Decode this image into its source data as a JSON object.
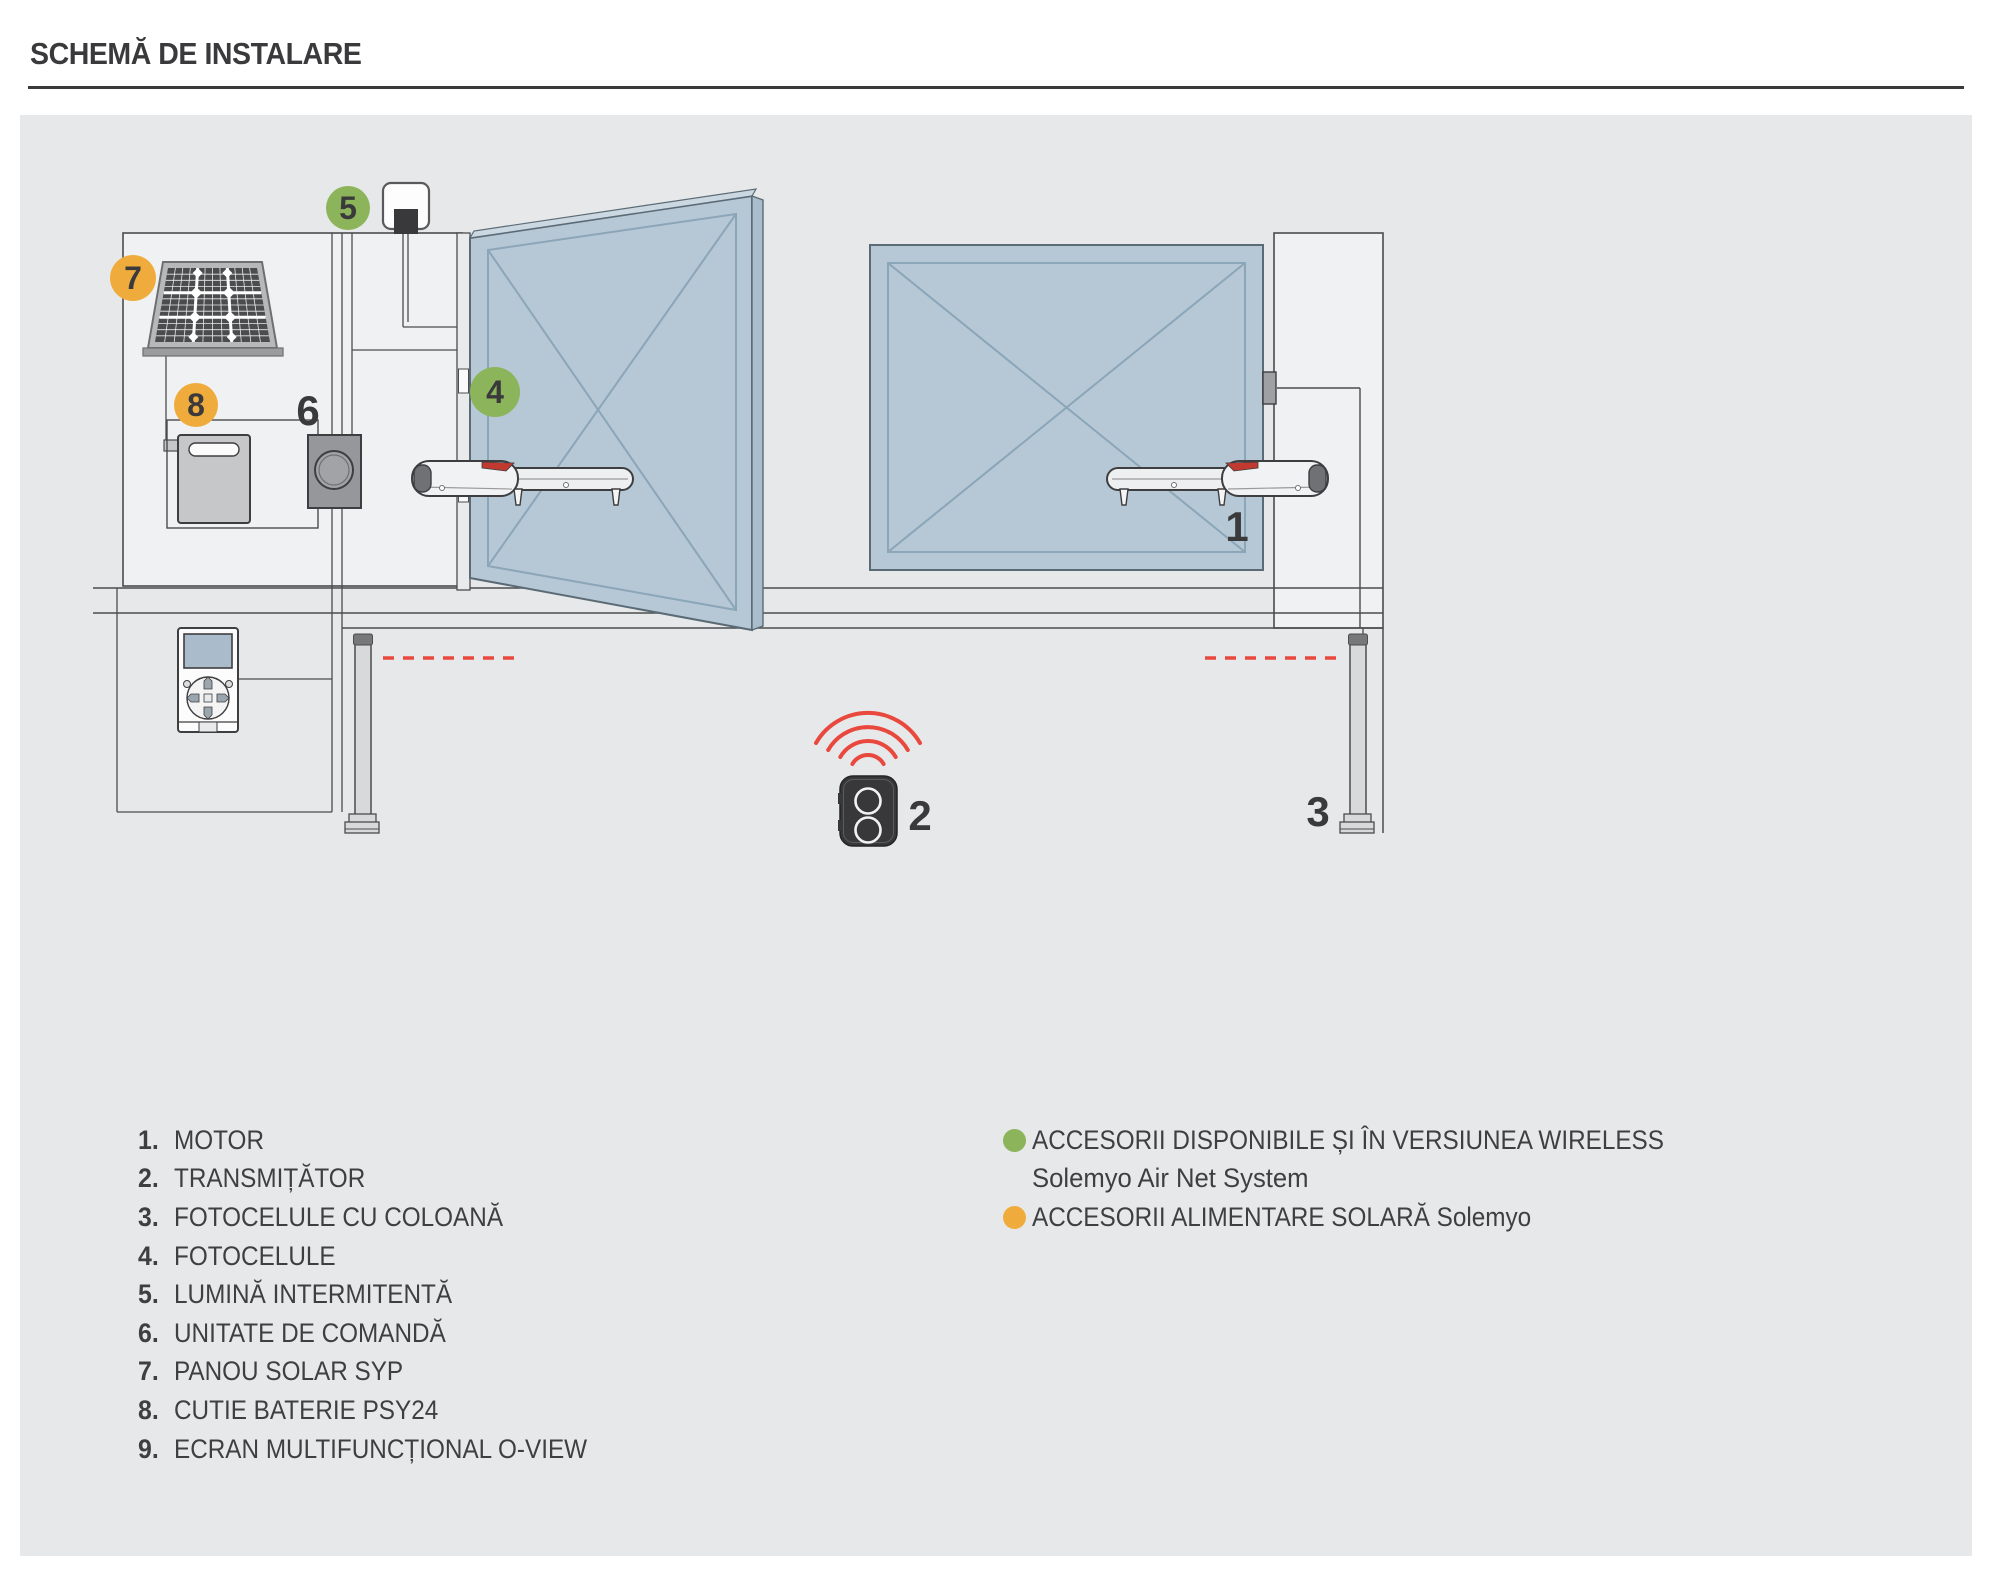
{
  "title": "SCHEMĂ DE INSTALARE",
  "colors": {
    "badge_green": "#8cb45a",
    "badge_orange": "#efac3d",
    "signal_red": "#e8483d",
    "gate_blue": "#b6c8d5",
    "panel_background": "#e7e8e9"
  },
  "diagram": {
    "labels": {
      "motor": "1",
      "transmitter": "2",
      "photocell_column": "3",
      "photocells": "4",
      "flashing_light": "5",
      "control_unit": "6",
      "solar_panel": "7",
      "battery_box": "8"
    }
  },
  "legend": {
    "items": [
      {
        "num": "1.",
        "label": "MOTOR"
      },
      {
        "num": "2.",
        "label": "TRANSMIȚĂTOR"
      },
      {
        "num": "3.",
        "label": "FOTOCELULE CU COLOANĂ"
      },
      {
        "num": "4.",
        "label": "FOTOCELULE"
      },
      {
        "num": "5.",
        "label": "LUMINĂ INTERMITENTĂ"
      },
      {
        "num": "6.",
        "label": "UNITATE DE COMANDĂ"
      },
      {
        "num": "7.",
        "label": "PANOU SOLAR SYP"
      },
      {
        "num": "8.",
        "label": "CUTIE BATERIE PSY24"
      },
      {
        "num": "9.",
        "label": "ECRAN MULTIFUNCȚIONAL O-VIEW"
      }
    ],
    "notes": [
      {
        "line1": "ACCESORII DISPONIBILE ȘI ÎN VERSIUNEA WIRELESS",
        "line2": "Solemyo Air Net System"
      },
      {
        "line1": "ACCESORII ALIMENTARE SOLARĂ Solemyo"
      }
    ]
  }
}
